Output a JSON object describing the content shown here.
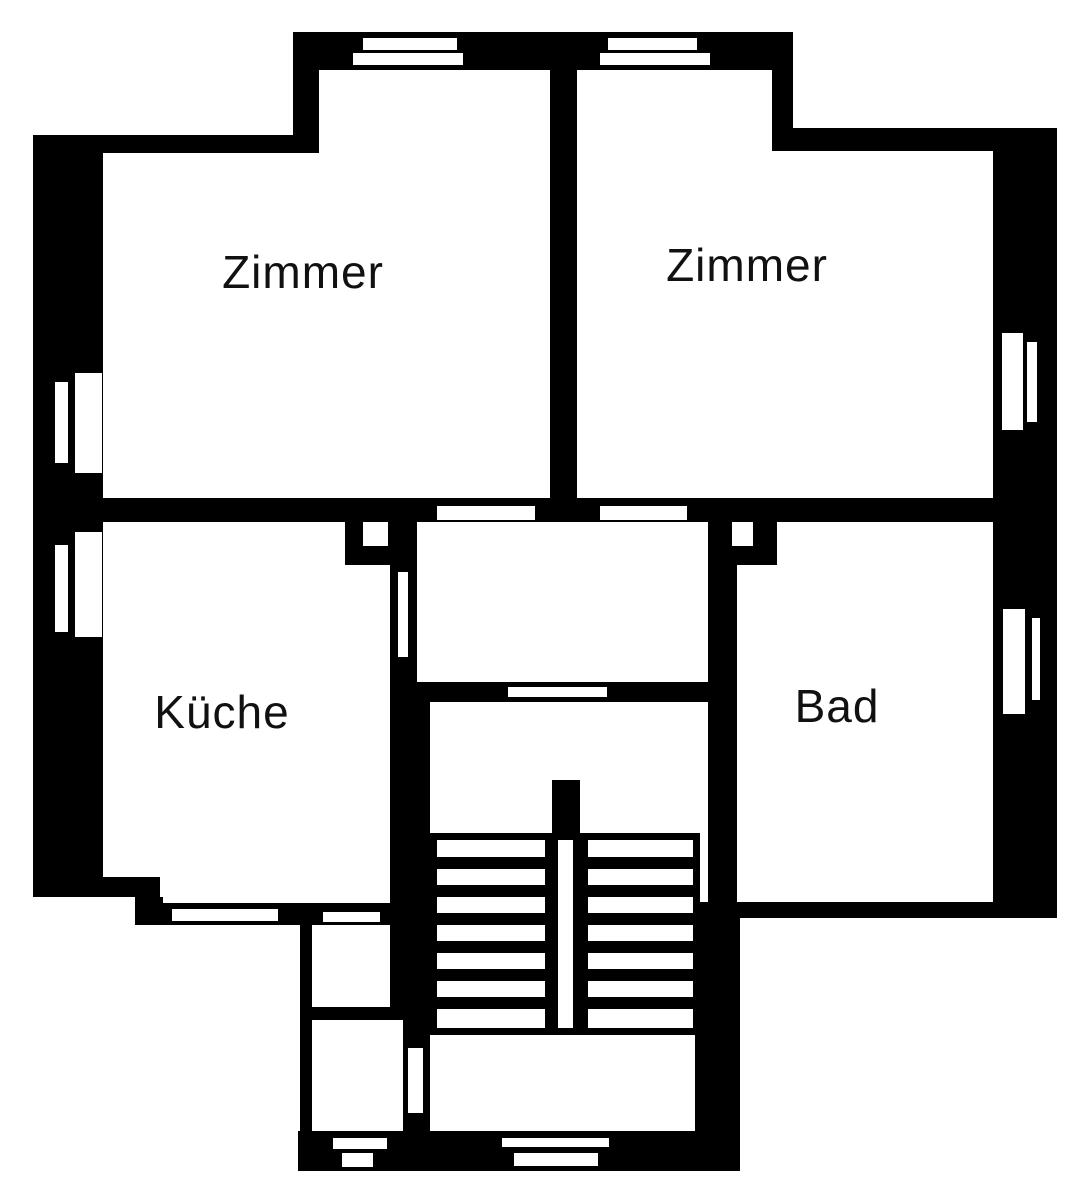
{
  "title": "Wohnungsgrundriss",
  "colors": {
    "wall": "#000000",
    "background": "#ffffff",
    "label": "#111111"
  },
  "rooms": [
    {
      "id": "zimmer-left",
      "label": "Zimmer"
    },
    {
      "id": "zimmer-right",
      "label": "Zimmer"
    },
    {
      "id": "kueche",
      "label": "Küche"
    },
    {
      "id": "bad",
      "label": "Bad"
    }
  ],
  "features": {
    "stairs_flights": 2,
    "stairs_treads_per_flight": 7,
    "entrance_doors": 2,
    "windows": 7
  }
}
